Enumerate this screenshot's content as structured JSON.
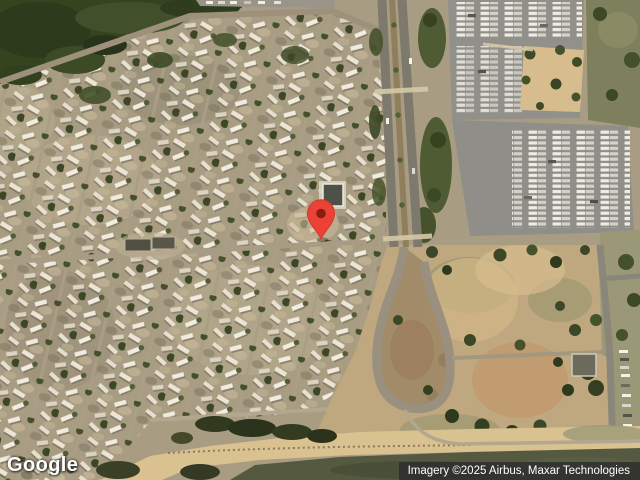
{
  "map": {
    "view": "satellite",
    "logo_text": "Google",
    "attribution_text": "Imagery ©2025 Airbus, Maxar Technologies",
    "marker": {
      "x": 321,
      "y": 239,
      "pin_color": "#EA4335",
      "dot_color": "#8E1B10",
      "outline_color": "#D6372A"
    },
    "colors": {
      "ground": "#a89d83",
      "forest_green": "#36431f",
      "road_gray": "#7e796d",
      "street_tan": "#a79c85",
      "parking_gray": "#92908a",
      "plaza_tan": "#d7bd8e",
      "park_tan": "#bfa87f",
      "sand": "#d9c190",
      "water_dark": "#545940"
    }
  }
}
